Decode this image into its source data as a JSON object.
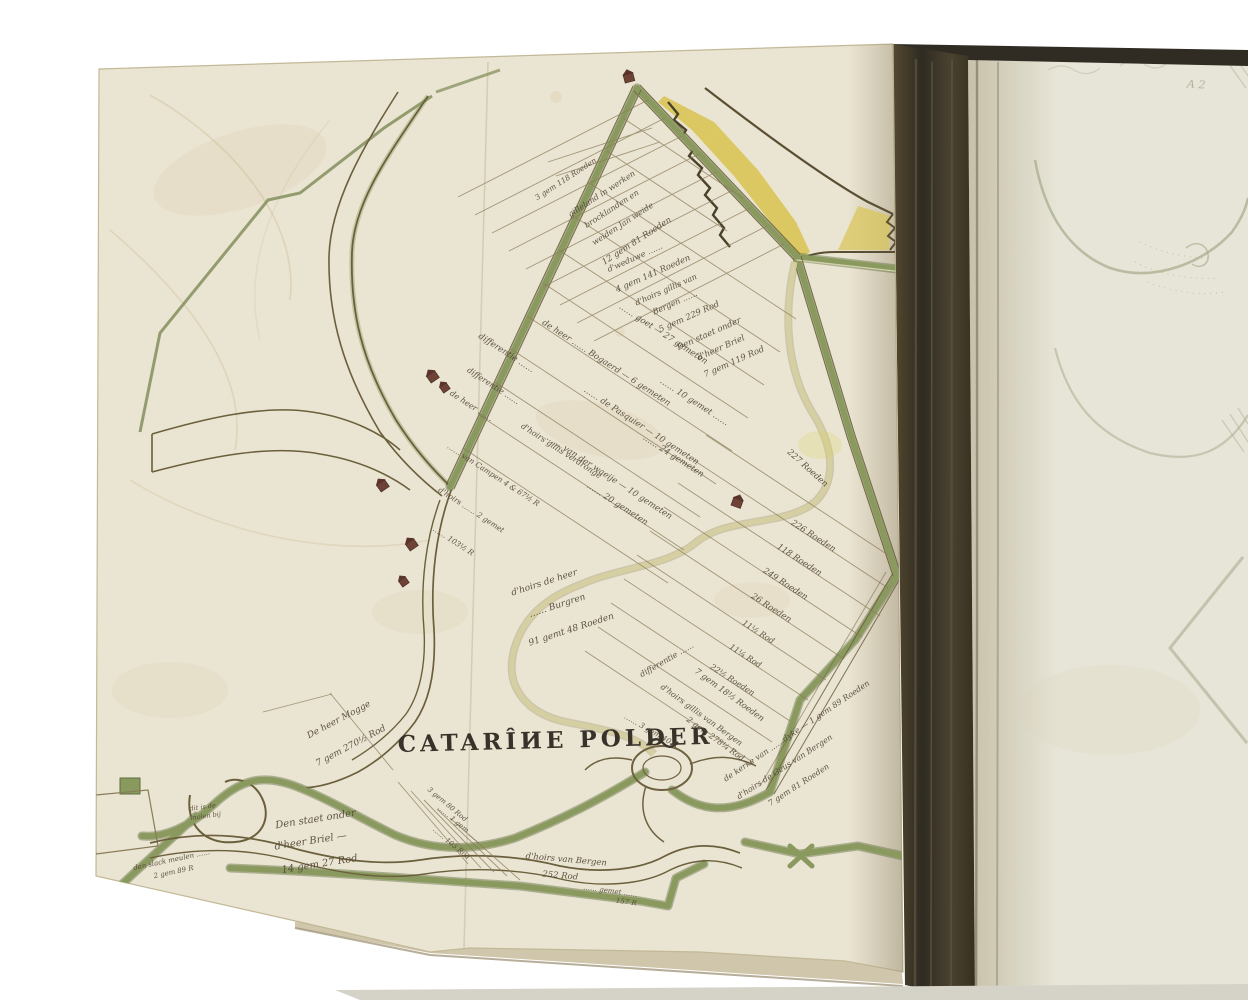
{
  "scene": {
    "background_color": "#ffffff",
    "book": {
      "left_page_color": "#eae4d2",
      "right_page_color": "#e7e5d7",
      "spine_color": "#3a3529",
      "dike_green": "#8a9a5f",
      "ink_brown": "#5c513a",
      "dune_yellow": "#d8c355",
      "building_red": "#6f4236"
    }
  },
  "map": {
    "title": "CATARÎИE POLDER",
    "folio_mark": "A 2",
    "labels": [
      "3 gem 118 Roeden",
      "gilleland in werken",
      "brocklanden en",
      "weiden Jan weide",
      "12 gem 81 Roeden",
      "d'weduwe ……",
      "4 gem 141 Roeden",
      "d'hoirs gillis van",
      "Bergen ……",
      "5 gem 229 Rod",
      "Den staet onder",
      "d'heer Briel",
      "7 gem 119 Rod",
      "differentie ……",
      "…… goet — 27 gemeten",
      "…… 10 gemet ……",
      "de heer …… Bogaerd — 6 gemeten",
      "…… 24 gemeten",
      "…… de Pasquier — 10 gemeten",
      "…… van der waeije — 10 gemeten",
      "…… 20 gemeten",
      "differentie ……",
      "de heer ……",
      "d'hoirs gillis verdronge",
      "…… van Campen 4 & 67½ R",
      "d'hoirs …… 2 gemet",
      "…… 103½ R",
      "227 Roeden",
      "226 Roeden",
      "118 Roeden",
      "249 Roeden",
      "26 Roeden",
      "11½ Rod",
      "11¼ Rod",
      "22½ Roeden",
      "differentie ……",
      "7 gem 18½ Roeden",
      "d'hoirs gillis van Bergen",
      "2 gem 278¼ Rod",
      "…… 3 gem 40 R",
      "de kerke van ……dyke — 1 gem 89 Roeden",
      "d'hoirs de Geus van Bergen",
      "7 gem 81 Roeden",
      "d'hoirs de heer",
      "…… Burgren",
      "91 gemt 48 Roeden",
      "De heer Mogge",
      "7 gem 270½ Rod",
      "Den staet onder",
      "d'heer Briel —",
      "14 gem 27 Rod",
      "dit is de",
      "molen bij",
      "den slack meulen ……",
      "2 gem 89 R",
      "3 gem 80 Rod",
      "…… 1 gem ……",
      "…… 105 Rod",
      "d'hoirs van Bergen",
      "252 Rod",
      "…… gemet ……",
      "157 R"
    ]
  }
}
